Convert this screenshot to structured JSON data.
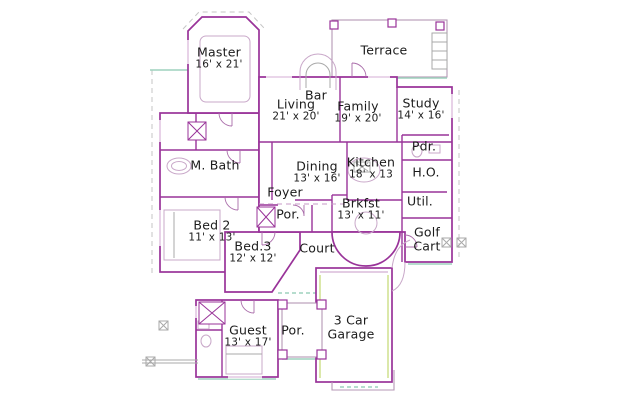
{
  "drawing": {
    "type": "residential-floor-plan",
    "background": "#ffffff",
    "colors": {
      "wall": "#993399",
      "wall_light": "#c79ac7",
      "slab_teal": "#9ed2bd",
      "detail_gray": "#a9a9a9",
      "accent_green": "#d2e394",
      "text": "#1b1b1b"
    }
  },
  "labels": {
    "master": {
      "line1": "Master",
      "line2": "16' x 21'"
    },
    "terrace": {
      "line1": "Terrace",
      "line2": ""
    },
    "bar": {
      "line1": "Bar",
      "line2": ""
    },
    "living": {
      "line1": "Living",
      "line2": "21' x 20'"
    },
    "family": {
      "line1": "Family",
      "line2": "19' x 20'"
    },
    "study": {
      "line1": "Study",
      "line2": "14' x 16'"
    },
    "pdr": {
      "line1": "Pdr.",
      "line2": ""
    },
    "m_bath": {
      "line1": "M. Bath",
      "line2": ""
    },
    "dining": {
      "line1": "Dining",
      "line2": "13' x 16'"
    },
    "kitchen": {
      "line1": "Kitchen",
      "line2": "18' x 13"
    },
    "ho": {
      "line1": "H.O.",
      "line2": ""
    },
    "foyer": {
      "line1": "Foyer",
      "line2": ""
    },
    "brkfst": {
      "line1": "Brkfst",
      "line2": "13' x 11'"
    },
    "util": {
      "line1": "Util.",
      "line2": ""
    },
    "bed2": {
      "line1": "Bed 2",
      "line2": "11' x 13'"
    },
    "por_front": {
      "line1": "Por.",
      "line2": ""
    },
    "golf_cart": {
      "line1": "Golf",
      "line2": "Cart"
    },
    "bed3": {
      "line1": "Bed.3",
      "line2": "12' x 12'"
    },
    "court": {
      "line1": "Court",
      "line2": ""
    },
    "guest": {
      "line1": "Guest",
      "line2": "13' x 17'"
    },
    "por_side": {
      "line1": "Por.",
      "line2": ""
    },
    "garage": {
      "line1": "3 Car",
      "line2": "Garage"
    }
  }
}
